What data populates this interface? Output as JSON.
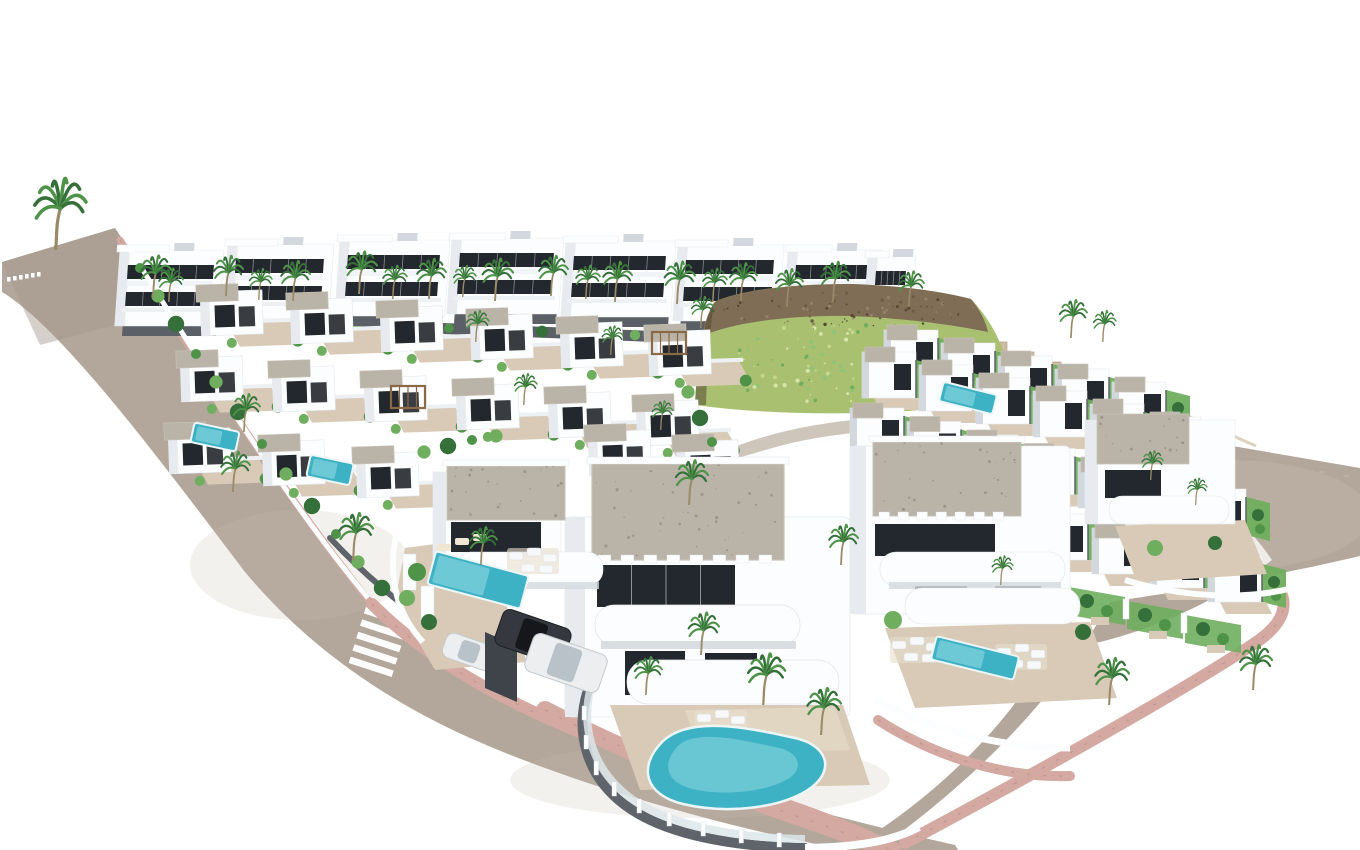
{
  "meta": {
    "title": "Aerial 3D architectural rendering of a white Mediterranean villa development with rooftop terraces, swimming pools, palm trees, curving roads with pink sidewalks, a zebra crosswalk and a rocky hill covered in green scrub",
    "width": 1360,
    "height": 850
  },
  "palette": {
    "bg": "#ffffff",
    "asphalt": "#b3a69b",
    "asphalt_dark": "#a4968b",
    "asphalt_light": "#cabdb2",
    "pink": "#d3a9a1",
    "pink_dark": "#b08680",
    "white": "#fcfdfe",
    "shade": "#e7ebef",
    "shade2": "#d2d8de",
    "win": "#23282e",
    "roof": "#b9b3a8",
    "roof_dot": "#938d81",
    "terr": "#d8cab6",
    "terr2": "#e8ddca",
    "pool": "#3eb2c5",
    "pool_hi": "#93dce2",
    "pool_rim": "#edf6f7",
    "green": "#4f9348",
    "green2": "#6fae5e",
    "green3": "#8cc579",
    "green_dark": "#35703a",
    "trunk": "#9a8a68",
    "rock": "#7f6d55",
    "rock_dark": "#564831",
    "grass": "#a8c070",
    "grass2": "#c6d68c",
    "step": "#cdbba3",
    "wall_dark": "#5f646b",
    "wall_darker": "#3f444a",
    "glass": "#dce6ea",
    "car_dark": "#35383e",
    "car_white": "#eceef0",
    "base_dark": "#5a6066",
    "rail": "#eef1f4"
  },
  "roads": {
    "left": "M 2,262 L 115,228 C 185,335 285,495 370,600 C 432,668 525,718 645,760 C 765,800 880,828 955,845 L 958,850 L 845,850 C 700,822 560,778 470,738 C 390,702 310,650 245,572 C 160,460 62,328 2,292 Z",
    "right": "M 940,398 L 1105,424 L 1360,468 L 1360,556 C 1250,582 1160,594 1110,602 C 1062,688 990,768 880,848 L 848,850 C 940,795 1010,722 1050,650 C 1110,646 1200,615 1272,560 C 1235,505 1160,448 1085,420 C 1030,405 980,398 940,398 Z",
    "access": "M 700,470 C 770,432 860,420 945,425",
    "tip_dashes": [
      [
        7,
        277
      ],
      [
        13,
        276
      ],
      [
        19,
        275
      ],
      [
        25,
        274
      ],
      [
        31,
        273
      ],
      [
        37,
        272
      ]
    ],
    "crosswalk": {
      "x": 366,
      "y": 607,
      "n": 5,
      "sx": -3.8,
      "sy": 12.4,
      "ux": 43,
      "uy": 14,
      "wx": -2.2,
      "wy": 6.4
    }
  },
  "sidewalks": {
    "upper": {
      "d": "M 120,240 C 188,345 288,500 370,602",
      "w": 7
    },
    "lower": {
      "d": "M 372,604 C 436,668 528,716 648,758 C 760,796 850,824 893,849",
      "w": 12
    },
    "front": {
      "d": "M 545,710 C 650,764 748,800 820,824 C 856,837 878,845 892,850",
      "w": 18
    },
    "right": {
      "d": "M 1000,386 C 1100,450 1200,520 1266,574 C 1294,598 1288,622 1252,645 C 1180,692 1060,760 905,843",
      "w": 12
    },
    "v2": {
      "d": "M 878,720 C 940,760 1010,778 1070,776",
      "w": 10
    }
  },
  "hill": {
    "grass": "M 695,405 C 697,360 702,330 714,302 C 740,290 790,284 850,284 C 905,286 945,292 972,300 C 995,325 1008,355 1008,378 C 1000,395 970,404 920,410 C 850,416 760,414 695,405 Z",
    "rock": "M 702,336 C 706,318 710,308 716,301 C 742,290 792,284 852,284 C 906,286 944,292 971,299 C 980,310 986,322 988,332 C 950,324 900,318 850,316 C 790,315 735,322 702,336 Z",
    "edge": "M 695,405 C 697,360 702,330 714,302 C 710,330 707,368 706,405 Z",
    "steps": "M 845,282 L 845,292 L 872,292 L 872,302 L 899,302 L 899,312 L 926,312 L 926,322 L 953,322 L 953,332 L 980,332 L 980,342 L 1007,342 L 1007,352 L 1034,352 L 1034,362 L 1061,362 L 1061,372 L 1088,372 L 1088,382 L 1030,362 L 935,320 L 845,290 Z",
    "wall2": [
      1088,
      372,
      1256,
      446
    ],
    "base_wall": "M 688,480 C 775,440 870,428 952,440",
    "grass_dots": {
      "cx": 852,
      "cy": 364,
      "rx": 145,
      "ry": 42,
      "n": 130
    },
    "rock_dots": {
      "cx": 845,
      "cy": 310,
      "rx": 135,
      "ry": 18,
      "n": 80
    }
  },
  "top_row": {
    "dark_strip": {
      "d": "M 165,318 L 748,340",
      "w": 11
    },
    "buildings": [
      [
        120,
        250,
        104
      ],
      [
        228,
        244,
        106
      ],
      [
        340,
        240,
        110
      ],
      [
        452,
        238,
        112
      ],
      [
        566,
        241,
        110
      ],
      [
        678,
        245,
        106
      ],
      [
        788,
        250,
        94
      ],
      [
        868,
        256,
        48
      ]
    ]
  },
  "mid_cluster": {
    "villas": [
      [
        200,
        292
      ],
      [
        290,
        300
      ],
      [
        380,
        308
      ],
      [
        470,
        316
      ],
      [
        560,
        324
      ],
      [
        648,
        332
      ],
      [
        180,
        358
      ],
      [
        272,
        368
      ],
      [
        364,
        378
      ],
      [
        456,
        386
      ],
      [
        548,
        394
      ],
      [
        636,
        402
      ],
      [
        168,
        430
      ],
      [
        262,
        442
      ],
      [
        356,
        454
      ],
      [
        588,
        432
      ],
      [
        676,
        442
      ]
    ],
    "pools": [
      [
        215,
        437,
        46,
        20,
        12
      ],
      [
        330,
        470,
        44,
        22,
        12
      ],
      [
        968,
        398,
        55,
        20,
        14
      ]
    ],
    "pergolas": [
      [
        391,
        386
      ],
      [
        652,
        332
      ]
    ],
    "wall": "M 128,246 C 195,355 290,505 368,598",
    "fence": "M 330,538 C 360,570 392,598 424,620",
    "bushes": [
      [
        140,
        268
      ],
      [
        158,
        296
      ],
      [
        176,
        324
      ],
      [
        196,
        354
      ],
      [
        216,
        382
      ],
      [
        238,
        412
      ],
      [
        262,
        444
      ],
      [
        286,
        474
      ],
      [
        312,
        506
      ],
      [
        336,
        534
      ],
      [
        358,
        562
      ],
      [
        382,
        588
      ],
      [
        406,
        610
      ],
      [
        688,
        392
      ],
      [
        700,
        418
      ],
      [
        712,
        442
      ],
      [
        424,
        452
      ],
      [
        448,
        446
      ],
      [
        472,
        440
      ],
      [
        496,
        436
      ]
    ]
  },
  "right_cluster": {
    "rows": [
      [
        884,
        330,
        5,
        57,
        13
      ],
      [
        862,
        352,
        6,
        57,
        13
      ],
      [
        850,
        408,
        7,
        57,
        13.5
      ],
      [
        860,
        472,
        7,
        58,
        14
      ]
    ],
    "garden_row": [
      895,
      545,
      6,
      58,
      14
    ],
    "ne_wall": [
      1088,
      368,
      1256,
      446
    ]
  },
  "foreground": {
    "v1": [
      565,
      455
    ],
    "v2": [
      845,
      432
    ],
    "v3": [
      395,
      452
    ],
    "v4": [
      1085,
      408
    ],
    "garage": [
      485,
      632,
      32,
      56
    ],
    "cars": [
      [
        470,
        652,
        54,
        26,
        19,
        "car_white"
      ],
      [
        533,
        637,
        72,
        38,
        19,
        "car_dark"
      ],
      [
        566,
        663,
        78,
        40,
        19,
        "car_white"
      ]
    ]
  },
  "palms": [
    [
      54,
      250,
      1.6
    ],
    [
      152,
      298,
      0.95
    ],
    [
      168,
      302,
      0.75
    ],
    [
      225,
      296,
      0.9
    ],
    [
      258,
      300,
      0.7
    ],
    [
      292,
      301,
      0.9
    ],
    [
      358,
      294,
      0.95
    ],
    [
      392,
      299,
      0.75
    ],
    [
      428,
      299,
      0.9
    ],
    [
      462,
      297,
      0.7
    ],
    [
      494,
      301,
      0.95
    ],
    [
      550,
      296,
      0.9
    ],
    [
      585,
      299,
      0.75
    ],
    [
      614,
      302,
      0.9
    ],
    [
      676,
      304,
      0.95
    ],
    [
      712,
      302,
      0.75
    ],
    [
      740,
      301,
      0.85
    ],
    [
      786,
      307,
      0.85
    ],
    [
      832,
      302,
      0.9
    ],
    [
      908,
      307,
      0.8
    ],
    [
      1070,
      338,
      0.85
    ],
    [
      1102,
      342,
      0.7
    ],
    [
      243,
      432,
      0.85
    ],
    [
      352,
      560,
      1.05
    ],
    [
      232,
      492,
      0.9
    ],
    [
      475,
      342,
      0.7
    ],
    [
      523,
      405,
      0.7
    ],
    [
      610,
      355,
      0.65
    ],
    [
      700,
      328,
      0.7
    ],
    [
      660,
      430,
      0.65
    ],
    [
      688,
      505,
      1.0
    ],
    [
      840,
      565,
      0.9
    ],
    [
      700,
      655,
      0.95
    ],
    [
      762,
      705,
      1.15
    ],
    [
      820,
      735,
      1.05
    ],
    [
      645,
      695,
      0.85
    ],
    [
      480,
      565,
      0.85
    ],
    [
      1108,
      705,
      1.05
    ],
    [
      1252,
      690,
      1.0
    ],
    [
      1150,
      480,
      0.65
    ],
    [
      1195,
      505,
      0.6
    ],
    [
      1000,
      585,
      0.65
    ]
  ],
  "marks": [
    [
      1322,
      472
    ],
    [
      1335,
      480
    ],
    [
      1347,
      476
    ]
  ]
}
